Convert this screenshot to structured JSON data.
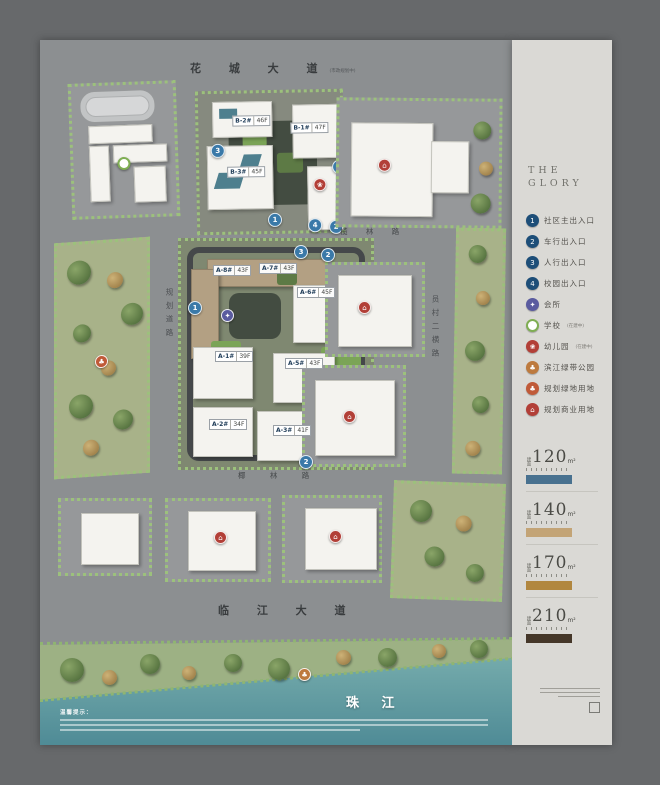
{
  "brand": {
    "line1": "THE",
    "line2": "GLORY"
  },
  "legend": {
    "items": [
      {
        "glyph": "1",
        "label": "社区主出入口",
        "note": "",
        "color": "#1d4e78",
        "fg": "#ffffff"
      },
      {
        "glyph": "2",
        "label": "车行出入口",
        "note": "",
        "color": "#1d4e78",
        "fg": "#ffffff"
      },
      {
        "glyph": "3",
        "label": "人行出入口",
        "note": "",
        "color": "#1d4e78",
        "fg": "#ffffff"
      },
      {
        "glyph": "4",
        "label": "校园出入口",
        "note": "",
        "color": "#1d4e78",
        "fg": "#ffffff"
      },
      {
        "glyph": "✦",
        "label": "会所",
        "note": "",
        "color": "#5a5b9f",
        "fg": "#ffffff"
      },
      {
        "glyph": "",
        "label": "学校",
        "note": "(在建中)",
        "color": "#ffffff",
        "fg": "#7fae53",
        "ring": "#7fae53"
      },
      {
        "glyph": "❀",
        "label": "幼儿园",
        "note": "(在建中)",
        "color": "#b23f37",
        "fg": "#ffffff"
      },
      {
        "glyph": "♣",
        "label": "滨江绿带公园",
        "note": "",
        "color": "#bd7a3e",
        "fg": "#ffffff"
      },
      {
        "glyph": "♣",
        "label": "规划绿地用地",
        "note": "",
        "color": "#c05a38",
        "fg": "#ffffff"
      },
      {
        "glyph": "⌂",
        "label": "规划商业用地",
        "note": "",
        "color": "#b23f37",
        "fg": "#ffffff"
      }
    ]
  },
  "areas": {
    "items": [
      {
        "prefix": "建面",
        "num": "120",
        "unit": "m²",
        "bar": "#48718f"
      },
      {
        "prefix": "建面",
        "num": "140",
        "unit": "m²",
        "bar": "#c3a476"
      },
      {
        "prefix": "建面",
        "num": "170",
        "unit": "m²",
        "bar": "#b1873f"
      },
      {
        "prefix": "建面",
        "num": "210",
        "unit": "m²",
        "bar": "#453729"
      }
    ]
  },
  "roads": {
    "top": "花 城 大 道",
    "top_note": "(市政规划中)",
    "inner_north": "榄 林 路",
    "inner_south": "椰 林 路",
    "left": "规划道路",
    "right": "员村二横路",
    "bottom": "临 江 大 道"
  },
  "river": {
    "label": "珠 江"
  },
  "disclaimer": {
    "heading": "温馨提示："
  },
  "map": {
    "chips": [
      {
        "name": "B-2#",
        "floors": "46F"
      },
      {
        "name": "B-1#",
        "floors": "47F"
      },
      {
        "name": "B-3#",
        "floors": "45F"
      },
      {
        "name": "A-8#",
        "floors": "43F"
      },
      {
        "name": "A-7#",
        "floors": "43F"
      },
      {
        "name": "A-6#",
        "floors": "45F"
      },
      {
        "name": "A-1#",
        "floors": "39F"
      },
      {
        "name": "A-5#",
        "floors": "43F"
      },
      {
        "name": "A-2#",
        "floors": "34F"
      },
      {
        "name": "A-3#",
        "floors": "41F"
      }
    ],
    "badges": [
      "3",
      "3",
      "1",
      "4",
      "2",
      "3",
      "2",
      "1",
      "2"
    ]
  }
}
